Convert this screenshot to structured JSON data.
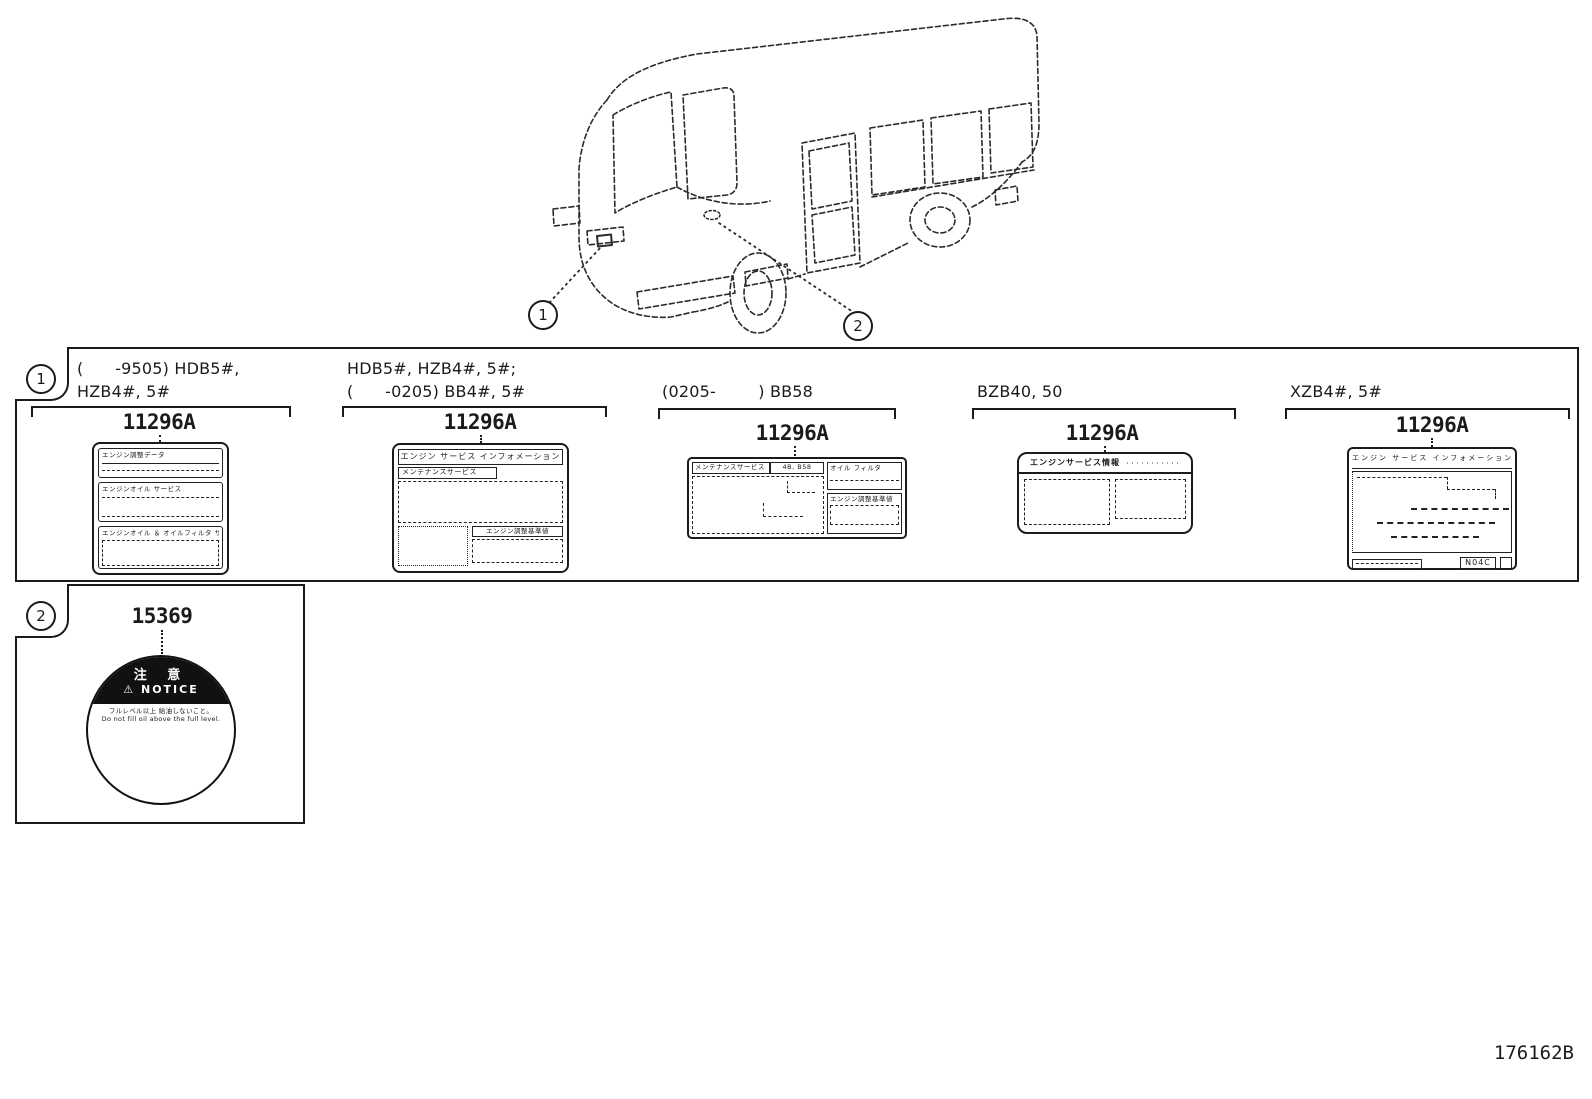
{
  "diagram": {
    "figure_code": "176162B",
    "callout1": "1",
    "callout2": "2"
  },
  "section1": {
    "tab_number": "1",
    "groups": [
      {
        "caption_line1": "(      -9505) HDB5#,",
        "caption_line2": "HZB4#, 5#",
        "part_number": "11296A"
      },
      {
        "caption_line1": "HDB5#, HZB4#, 5#;",
        "caption_line2": "(      -0205) BB4#, 5#",
        "part_number": "11296A"
      },
      {
        "caption_line1": "(0205-        ) BB58",
        "part_number": "11296A"
      },
      {
        "caption_line1": "BZB40, 50",
        "part_number": "11296A"
      },
      {
        "caption_line1": "XZB4#, 5#",
        "part_number": "11296A"
      }
    ],
    "label_a": {
      "sec1_title": "エンジン調整データ",
      "sec2_title": "エンジンオイル サービス",
      "sec3_title": "エンジンオイル ＆ オイルフィルタ サービス"
    },
    "label_b": {
      "header": "エンジン サービス インフォメーション",
      "subheader": "メンテナンスサービス",
      "corner_title": "エンジン調整基準値"
    },
    "label_c": {
      "bar_left": "メンテナンスサービス",
      "bar_right": "4B, B58",
      "right_top_title": "オイル フィルタ",
      "right_bottom_title": "エンジン調整基準値"
    },
    "label_d": {
      "header": "エンジンサービス情報",
      "header_note": "・・・・・・・・・・・"
    },
    "label_e": {
      "header": "エンジン サービス インフォメーション",
      "engine_code": "N04C"
    }
  },
  "section2": {
    "tab_number": "2",
    "part_number": "15369",
    "caution_label": {
      "warning_icon": "⚠",
      "warning_jp": "注 意",
      "warning_en": "NOTICE",
      "text_line1": "フルレベル以上 給油しないこと。",
      "text_line2": "Do not fill oil above the full level."
    }
  }
}
